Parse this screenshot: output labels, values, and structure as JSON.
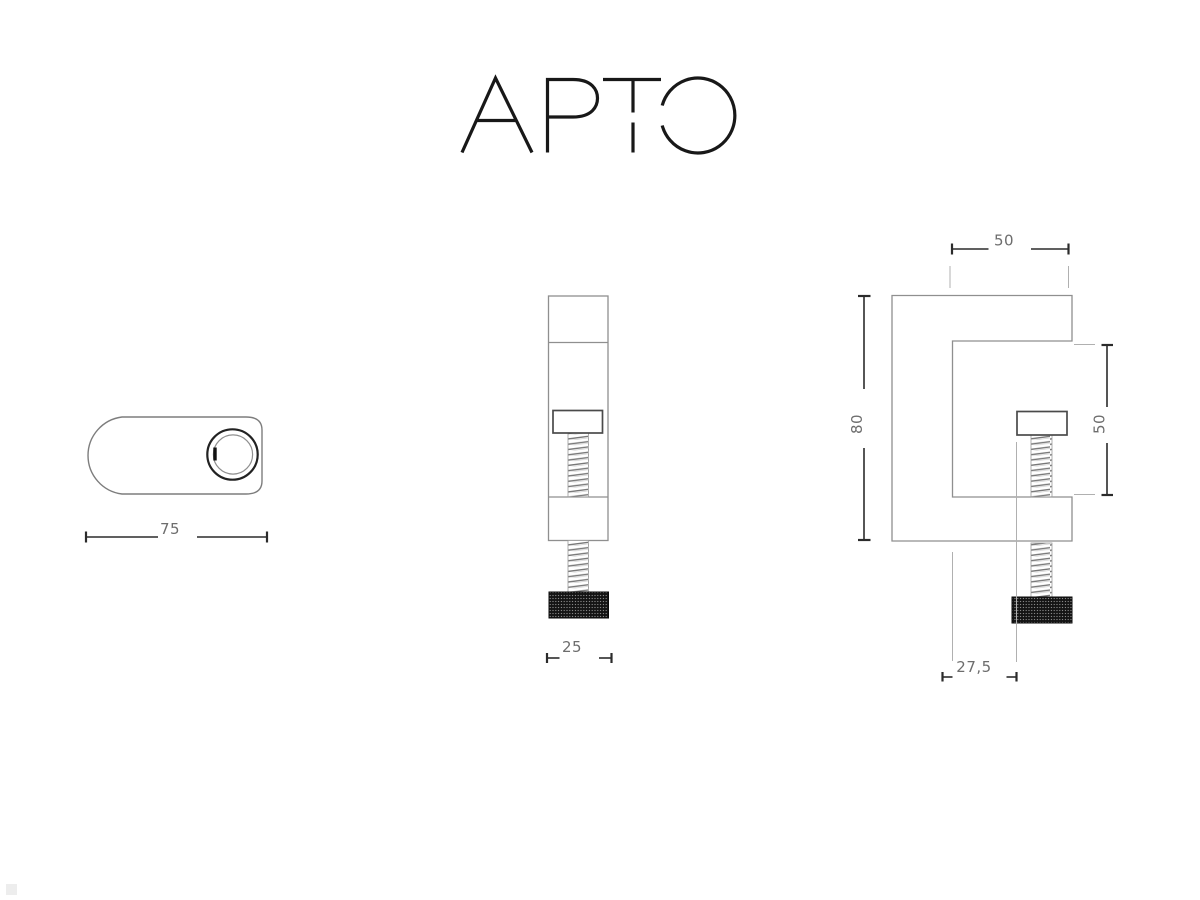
{
  "page": {
    "background": "#ffffff"
  },
  "logo": {
    "text": "APTO"
  },
  "drawing": {
    "top_view": {
      "name": "cylinder-top-view",
      "dim_length": "75"
    },
    "front_view": {
      "name": "clamp-front-view",
      "dim_width": "25"
    },
    "side_view": {
      "name": "clamp-side-view",
      "dim_arm_length": "50",
      "dim_height": "80",
      "dim_opening_height": "50",
      "dim_screw_offset": "27,5"
    },
    "colors": {
      "outline": "#8f8f8f",
      "accent_dark": "#1e1e1e",
      "screw_head_outline": "#4a4a4a",
      "dimension_line": "#2b2b2b",
      "extension_line": "#b0b0b0",
      "dimension_text": "#6d6d6d",
      "knob": "#141414"
    }
  }
}
